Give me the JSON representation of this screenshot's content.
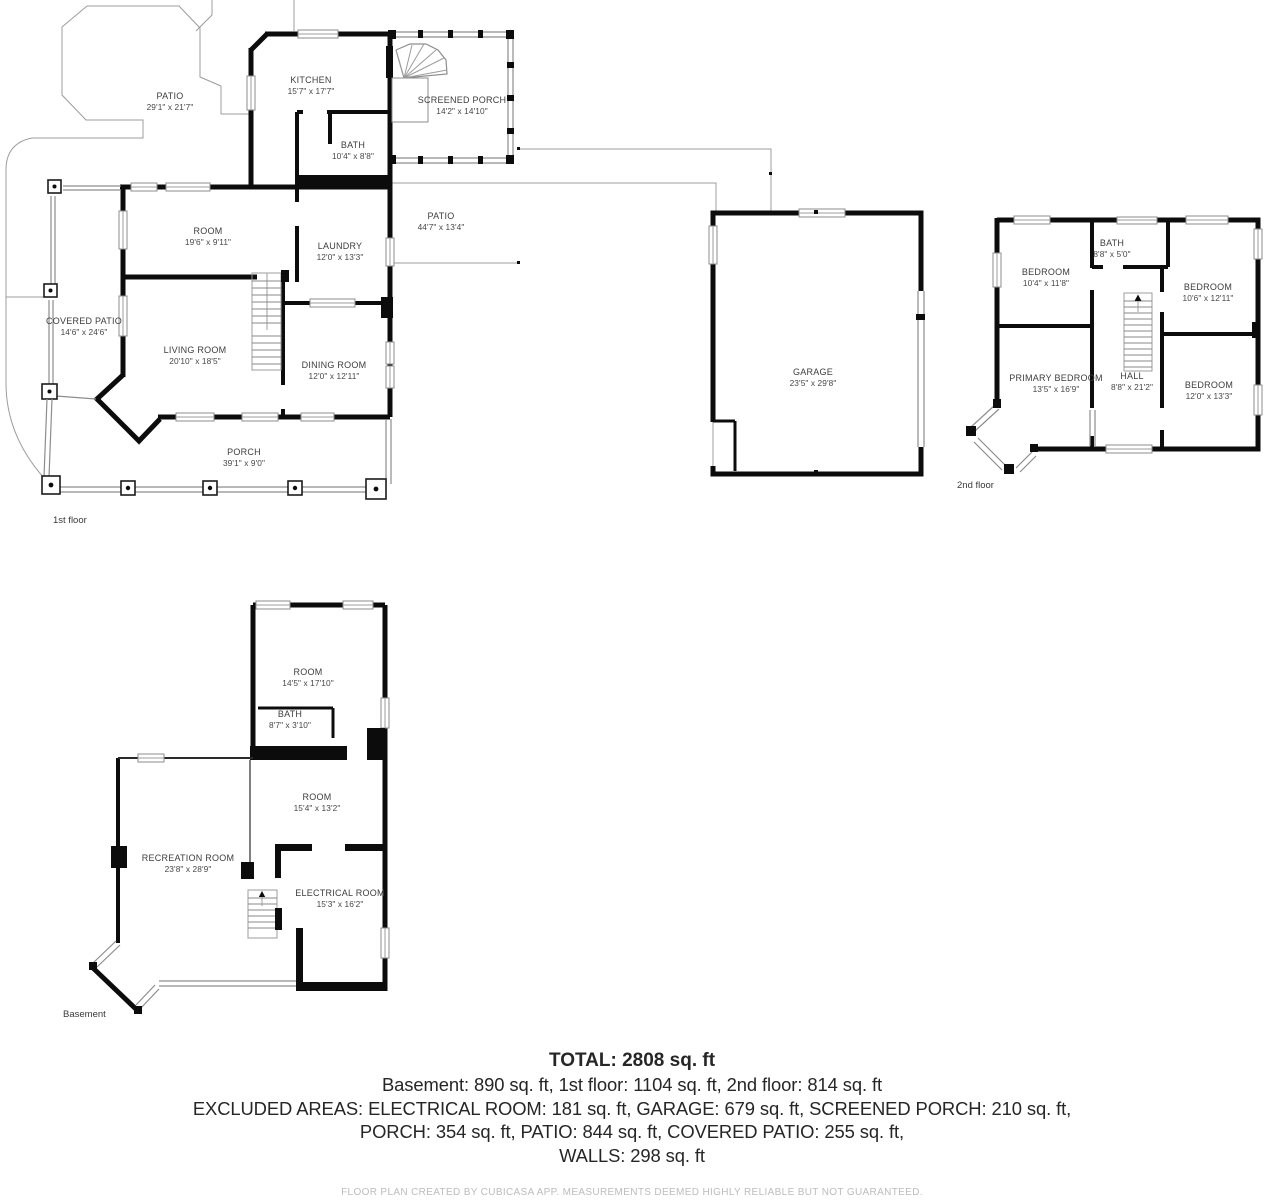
{
  "colors": {
    "background": "#ffffff",
    "wall": "#0c0c0c",
    "thin_line": "#9c9c9c",
    "room_text": "#3d3d3d",
    "summary_text": "#262626",
    "footer_text": "#bcbcbc"
  },
  "floor_plans": {
    "first_floor": {
      "floor_label": "1st floor",
      "rooms": [
        {
          "name": "PATIO",
          "dims": "29'1\" x 21'7\""
        },
        {
          "name": "KITCHEN",
          "dims": "15'7\" x 17'7\""
        },
        {
          "name": "SCREENED PORCH",
          "dims": "14'2\" x 14'10\""
        },
        {
          "name": "BATH",
          "dims": "10'4\" x 8'8\""
        },
        {
          "name": "ROOM",
          "dims": "19'6\" x 9'11\""
        },
        {
          "name": "LAUNDRY",
          "dims": "12'0\" x 13'3\""
        },
        {
          "name": "PATIO",
          "dims": "44'7\" x 13'4\""
        },
        {
          "name": "COVERED PATIO",
          "dims": "14'6\" x 24'6\""
        },
        {
          "name": "LIVING ROOM",
          "dims": "20'10\" x 18'5\""
        },
        {
          "name": "DINING ROOM",
          "dims": "12'0\" x 12'11\""
        },
        {
          "name": "PORCH",
          "dims": "39'1\" x 9'0\""
        }
      ]
    },
    "garage": {
      "rooms": [
        {
          "name": "GARAGE",
          "dims": "23'5\" x 29'8\""
        }
      ]
    },
    "second_floor": {
      "floor_label": "2nd floor",
      "rooms": [
        {
          "name": "BEDROOM",
          "dims": "10'4\" x 11'8\""
        },
        {
          "name": "BATH",
          "dims": "8'8\" x 5'0\""
        },
        {
          "name": "BEDROOM",
          "dims": "10'6\" x 12'11\""
        },
        {
          "name": "PRIMARY BEDROOM",
          "dims": "13'5\" x 16'9\""
        },
        {
          "name": "HALL",
          "dims": "8'8\" x 21'2\""
        },
        {
          "name": "BEDROOM",
          "dims": "12'0\" x 13'3\""
        }
      ]
    },
    "basement": {
      "floor_label": "Basement",
      "rooms": [
        {
          "name": "ROOM",
          "dims": "14'5\" x 17'10\""
        },
        {
          "name": "BATH",
          "dims": "8'7\" x 3'10\""
        },
        {
          "name": "ROOM",
          "dims": "15'4\" x 13'2\""
        },
        {
          "name": "RECREATION ROOM",
          "dims": "23'8\" x 28'9\""
        },
        {
          "name": "ELECTRICAL ROOM",
          "dims": "15'3\" x 16'2\""
        }
      ]
    }
  },
  "summary": {
    "total": "TOTAL: 2808 sq. ft",
    "line1": "Basement: 890 sq. ft, 1st floor: 1104 sq. ft, 2nd floor: 814 sq. ft",
    "line2": "EXCLUDED AREAS: ELECTRICAL ROOM: 181 sq. ft, GARAGE: 679 sq. ft, SCREENED PORCH: 210 sq. ft,",
    "line3": "PORCH: 354 sq. ft, PATIO: 844 sq. ft, COVERED PATIO: 255 sq. ft,",
    "line4": "WALLS: 298 sq. ft"
  },
  "footer": "FLOOR PLAN CREATED BY CUBICASA APP. MEASUREMENTS DEEMED HIGHLY RELIABLE BUT NOT GUARANTEED."
}
